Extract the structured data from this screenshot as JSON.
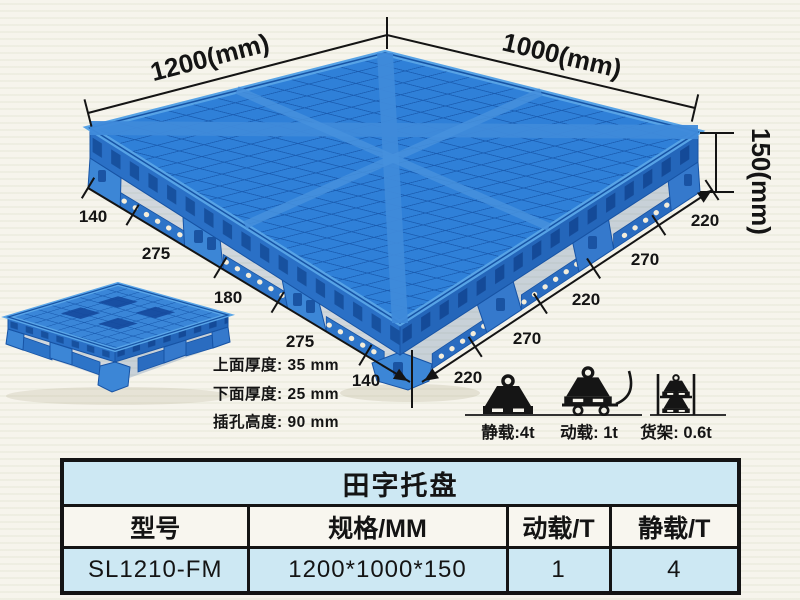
{
  "diagram": {
    "length_label": "1200(mm)",
    "width_label": "1000(mm)",
    "height_label": "150(mm)",
    "left_chain": [
      "140",
      "275",
      "180",
      "275",
      "140"
    ],
    "right_chain": [
      "220",
      "270",
      "220",
      "270",
      "220"
    ],
    "thickness_notes": [
      "上面厚度: 35 mm",
      "下面厚度: 25 mm",
      "插孔高度: 90 mm"
    ]
  },
  "load_icons": {
    "static_label": "静载:4t",
    "dynamic_label": "动载: 1t",
    "rack_label": "货架: 0.6t"
  },
  "spec_table": {
    "title": "田字托盘",
    "headers": [
      "型号",
      "规格/MM",
      "动载/T",
      "静载/T"
    ],
    "rows": [
      [
        "SL1210-FM",
        "1200*1000*150",
        "1",
        "4"
      ]
    ]
  },
  "colors": {
    "pallet_blue": "#2f80d8",
    "pallet_dark_blue": "#1a5cb0",
    "table_row_blue": "#cde8f3",
    "background": "#f6f4ec"
  }
}
